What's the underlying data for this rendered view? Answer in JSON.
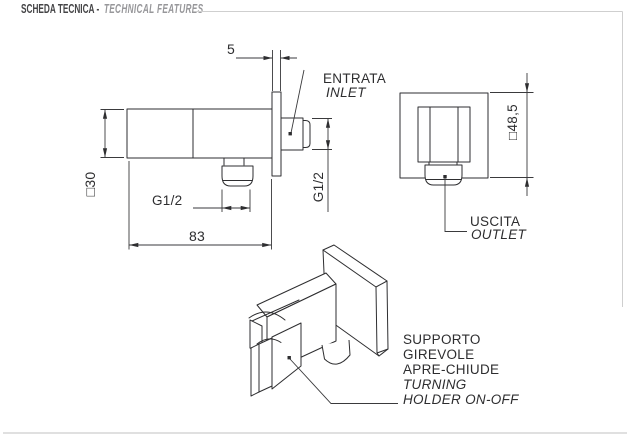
{
  "header": {
    "title_it": "SCHEDA TECNICA -",
    "title_en": "TECHNICAL FEATURES"
  },
  "side_view": {
    "dims": {
      "plate_offset": "5",
      "body_length": "83",
      "body_section": "□30",
      "outlet_thread": "G1/2",
      "inlet_thread": "G1/2"
    },
    "inlet_label": {
      "it": "ENTRATA",
      "en": "INLET"
    }
  },
  "front_view": {
    "dims": {
      "plate_size": "□48,5"
    },
    "outlet_label": {
      "it": "USCITA",
      "en": "OUTLET"
    }
  },
  "iso_view": {
    "labels": [
      "SUPPORTO",
      "GIREVOLE",
      "APRE-CHIUDE",
      "TURNING",
      "HOLDER ON-OFF"
    ]
  },
  "colors": {
    "line": "#2e2e30",
    "header_title": "#454547",
    "header_subtitle": "#97979a",
    "rule_gray": "#cfcfcf",
    "background": "#ffffff"
  }
}
